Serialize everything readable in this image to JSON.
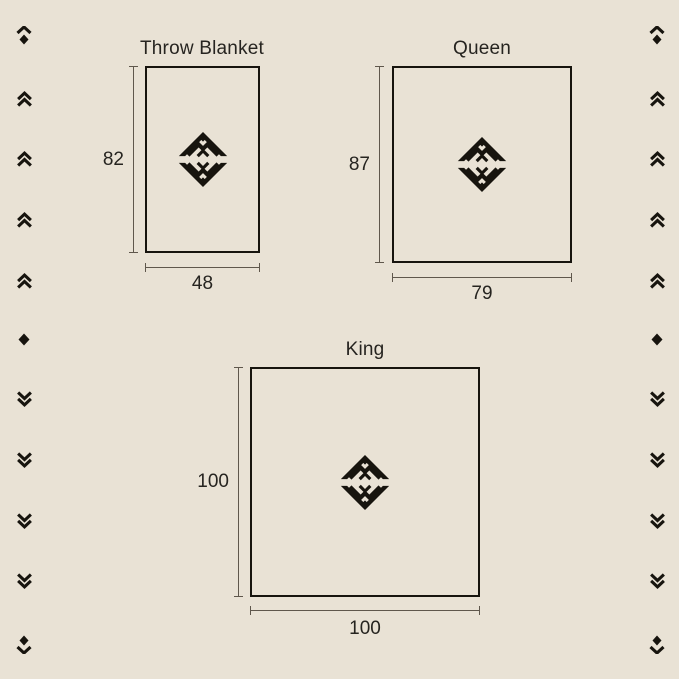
{
  "palette": {
    "background": "#e9e2d5",
    "ink": "#17140e",
    "dim_line": "#5f574c",
    "text": "#262420"
  },
  "diagrams": [
    {
      "id": "throw-blanket",
      "title": "Throw Blanket",
      "height": "82",
      "width": "48"
    },
    {
      "id": "queen",
      "title": "Queen",
      "height": "87",
      "width": "79"
    },
    {
      "id": "king",
      "title": "King",
      "height": "100",
      "width": "100"
    }
  ],
  "motif_icon": "diamond-mountain-monogram",
  "side_icon_sequence": [
    "chevron-up-diamond",
    "double-chevron-up",
    "double-chevron-up",
    "double-chevron-up",
    "double-chevron-up",
    "diamond",
    "double-chevron-down",
    "double-chevron-down",
    "double-chevron-down",
    "double-chevron-down",
    "diamond-chevron-down"
  ]
}
